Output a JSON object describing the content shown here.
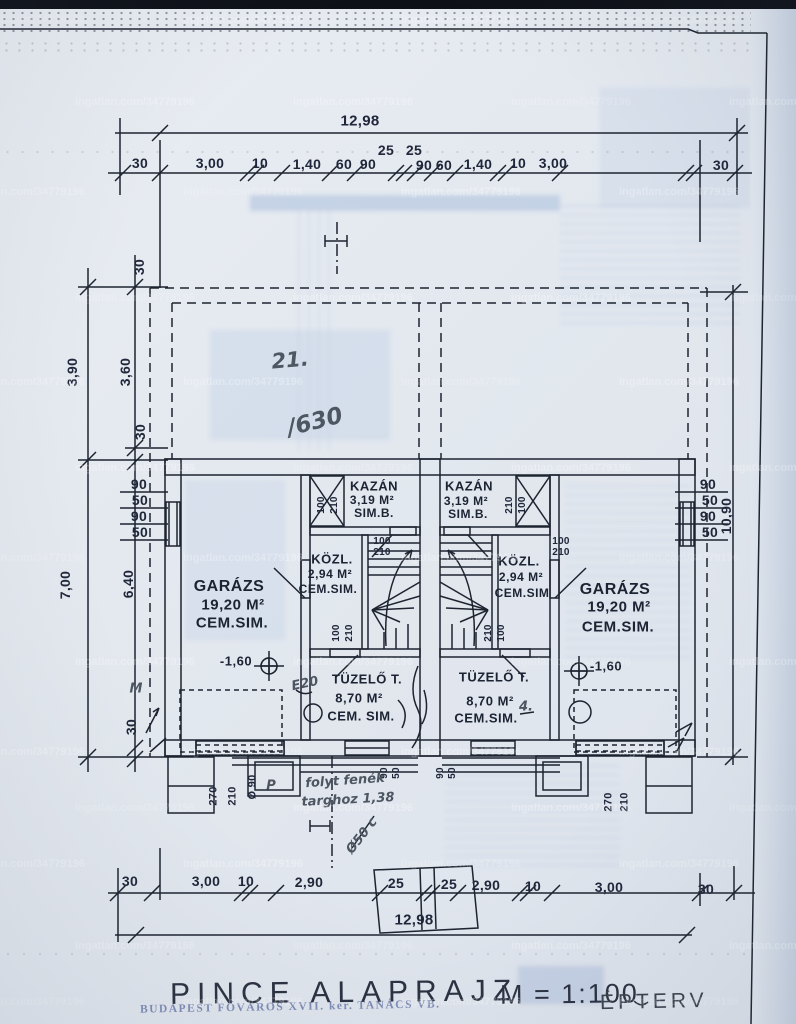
{
  "watermark": {
    "text": "ingatlan.com/34779196"
  },
  "titleblock": {
    "title": "PINCE  ALAPRAJZ",
    "scale": "M = 1:100",
    "stamp": "BUDAPEST FŐVÁROS XVII. ker. TANÁCS VB.",
    "firm": "ÉPTERV"
  },
  "plot": {
    "number": "21.",
    "sub": "/630"
  },
  "dims": {
    "top": {
      "total": "12,98",
      "chain": [
        "30",
        "3,00",
        "10",
        "1,40",
        "60",
        "90",
        "25",
        "25",
        "90",
        "60",
        "1,40",
        "10",
        "3,00",
        "30"
      ]
    },
    "bottom": {
      "total": "12,98",
      "chain": [
        "30",
        "3,00",
        "10",
        "2,90",
        "25",
        "25",
        "2,90",
        "10",
        "3,00",
        "30"
      ]
    },
    "left": {
      "outer": [
        "3,90",
        "7,00"
      ],
      "inner": [
        "30",
        "3,60",
        "30",
        "6,40",
        "30"
      ],
      "mini": [
        "90",
        "50",
        "90",
        "50"
      ]
    },
    "right": {
      "total": "10,90",
      "mini": [
        "90",
        "50",
        "90",
        "50"
      ]
    }
  },
  "rooms": {
    "kazan_left": {
      "name": "KAZÁN",
      "area": "3,19 M²",
      "finish": "SIM.B."
    },
    "kazan_right": {
      "name": "KAZÁN",
      "area": "3,19 M²",
      "finish": "SIM.B."
    },
    "kozl_left": {
      "name": "KÖZL.",
      "area": "2,94 M²",
      "finish": "CEM.SIM."
    },
    "kozl_right": {
      "name": "KÖZL.",
      "area": "2,94 M²",
      "finish": "CEM.SIM"
    },
    "garage_left": {
      "name": "GARÁZS",
      "area": "19,20 M²",
      "finish": "CEM.SIM.",
      "level": "-1,60"
    },
    "garage_right": {
      "name": "GARÁZS",
      "area": "19,20 M²",
      "finish": "CEM.SIM.",
      "level": "-1,60"
    },
    "tuzelo_left": {
      "name": "TÜZELŐ T.",
      "area": "8,70 M²",
      "finish": "CEM. SIM."
    },
    "tuzelo_right": {
      "name": "TÜZELŐ T.",
      "area": "8,70 M²",
      "finish": "CEM.SIM."
    }
  },
  "openings": {
    "door_w": "100",
    "door_h": "210",
    "garage_w": "270",
    "garage_h": "210",
    "dia": "Ø 90"
  },
  "notes": {
    "m_mark": "M",
    "e_mark": "E20",
    "line1": "folyt fenék",
    "line2": "targhoz 1,38",
    "flue": "Ø50 c",
    "p_mark": "P",
    "four": "4."
  }
}
